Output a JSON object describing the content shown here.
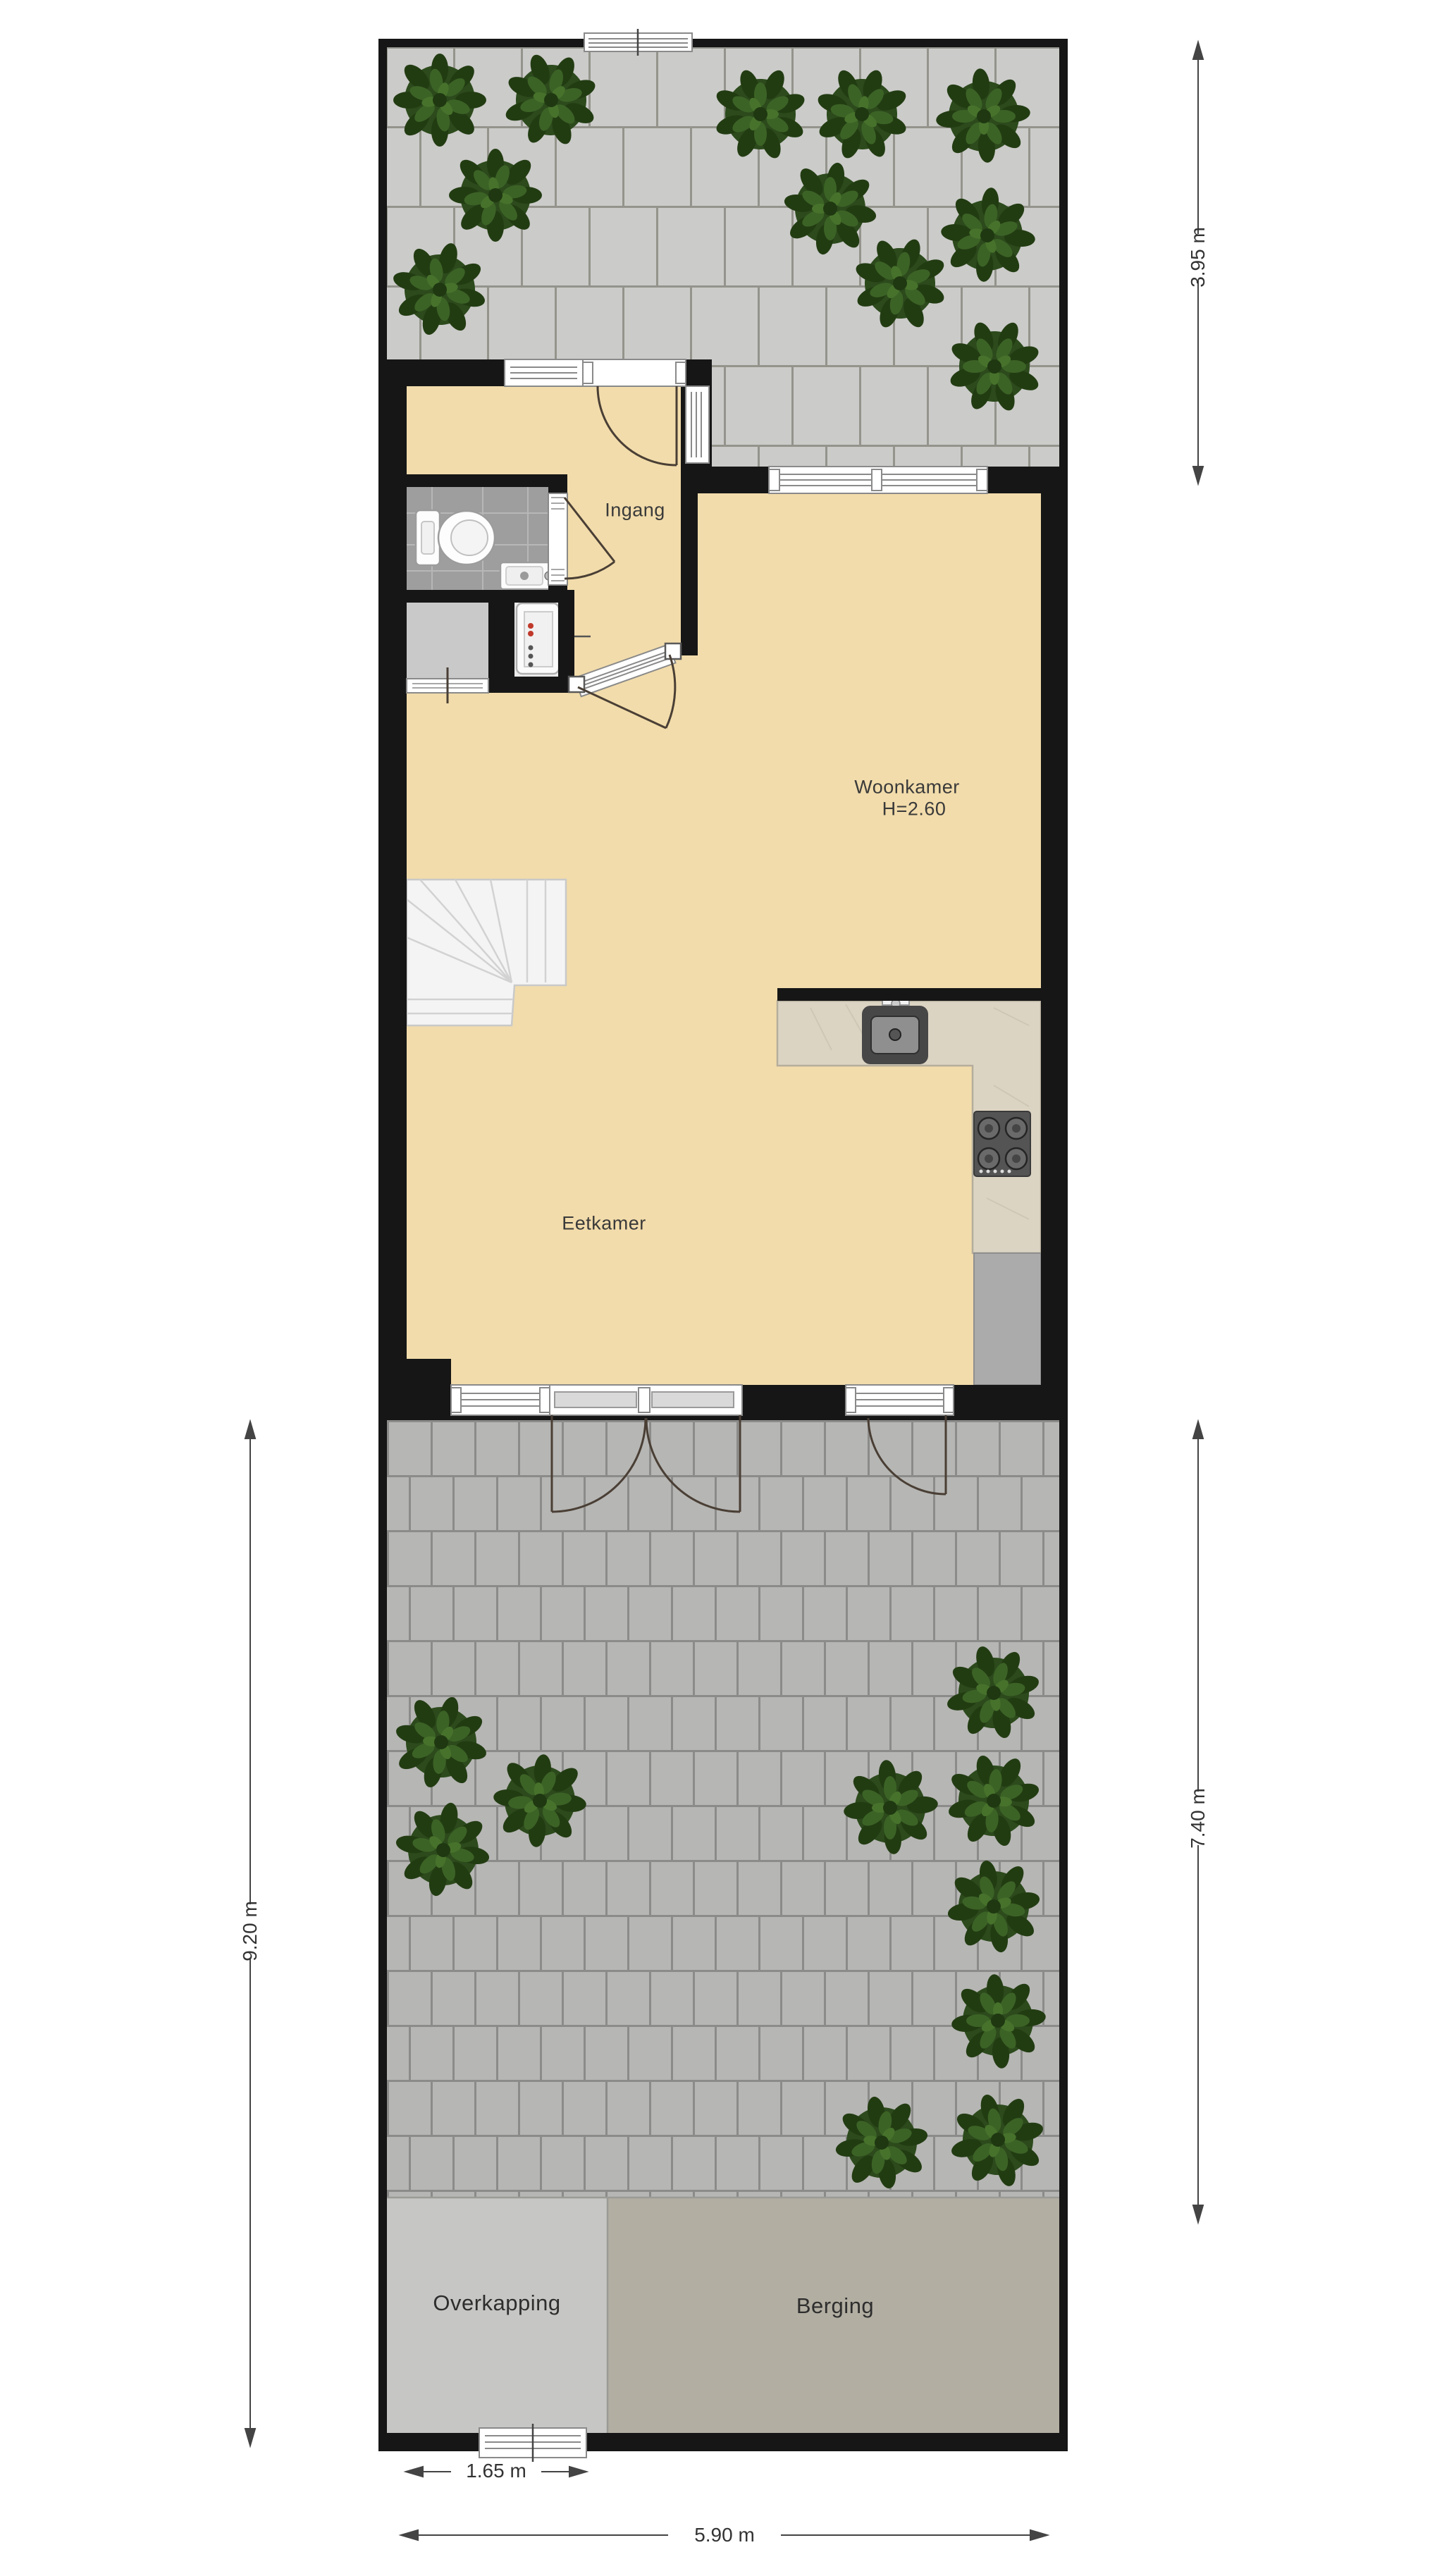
{
  "rooms": {
    "ingang": "Ingang",
    "woonkamer": "Woonkamer",
    "woonkamer_height": "H=2.60",
    "eetkamer": "Eetkamer",
    "overkapping": "Overkapping",
    "berging": "Berging"
  },
  "dimensions": {
    "garden_top": "3.95 m",
    "garden_bottom_right": "7.40 m",
    "garden_bottom_left": "9.20 m",
    "gate_width": "1.65 m",
    "plot_width": "5.90 m"
  },
  "colors": {
    "wall": "#161616",
    "floor": "#f2dcab",
    "tiles_top_garden": "#cbcbc9",
    "tiles_bottom_garden": "#b6b6b4",
    "bush_green": "#2c4a1c",
    "bathroom_floor": "#9e9e9e",
    "closet_floor": "#c9c9c9",
    "overkapping_fill": "#c6c6c4",
    "berging_fill": "#b2aea2",
    "counter_fill": "#dcd4c3",
    "dimension_line": "#444444"
  }
}
